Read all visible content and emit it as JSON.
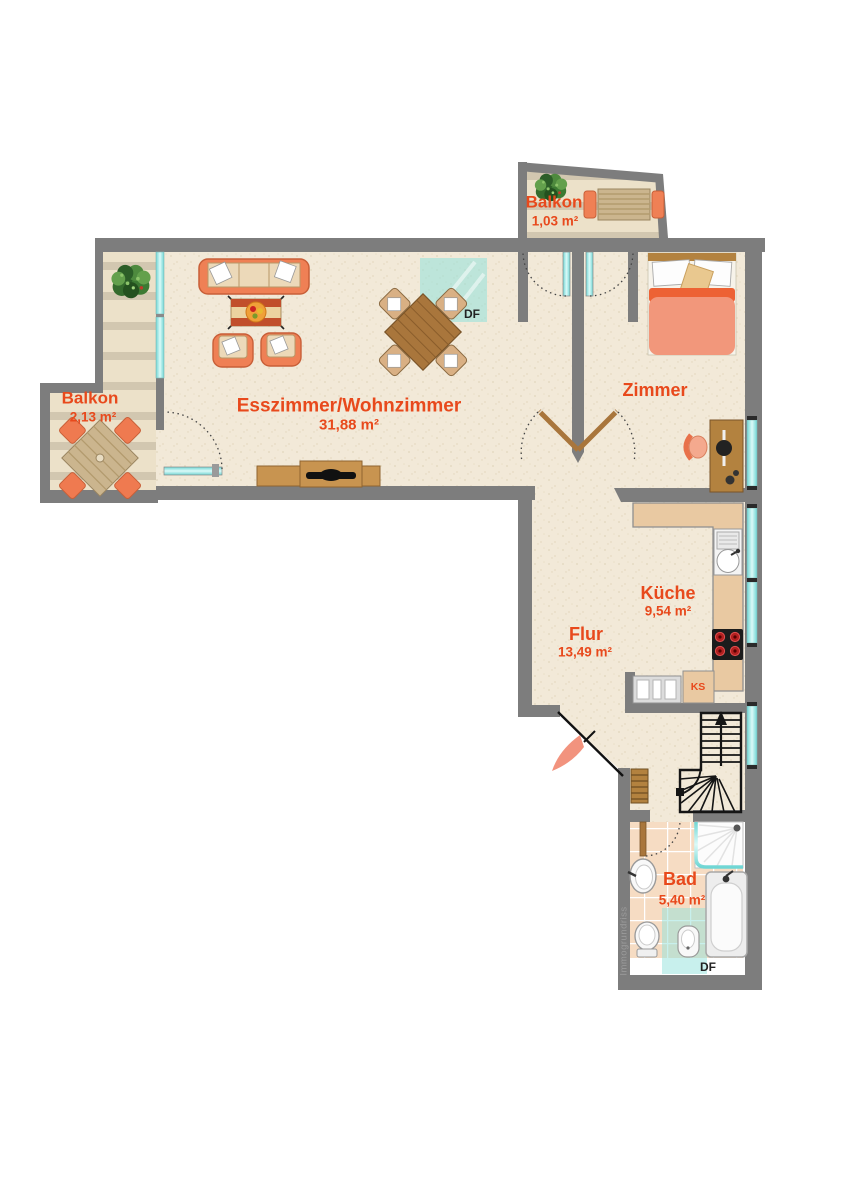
{
  "document": "floor-plan",
  "rooms": [
    {
      "name": "Balkon",
      "area": "1,03 m²"
    },
    {
      "name": "Zimmer",
      "area": ""
    },
    {
      "name": "Esszimmer/Wohnzimmer",
      "area": "31,88 m²"
    },
    {
      "name": "Balkon",
      "area": "2,13 m²"
    },
    {
      "name": "Küche",
      "area": "9,54 m²"
    },
    {
      "name": "Flur",
      "area": "13,49 m²"
    },
    {
      "name": "Bad",
      "area": "5,40 m²"
    }
  ],
  "annotations": {
    "skylight_living": "DF",
    "skylight_bath": "DF",
    "fridge": "KS",
    "watermark": "Immogrundriss"
  },
  "colors": {
    "wall": "#7d7d7d",
    "floor": "#f2e9d8",
    "deck_light": "#ece1c9",
    "deck_dark": "#d2c7b0",
    "label_orange": "#e8491c",
    "glass_cyan": "#7fdede",
    "skylight": "rgba(145,225,220,0.55)",
    "furniture_orange": "#ef8055",
    "cushion_tan": "#ecd9b9",
    "wood": "#a9763c",
    "counter": "#e9c9a2",
    "tile": "#f6dcc3"
  }
}
